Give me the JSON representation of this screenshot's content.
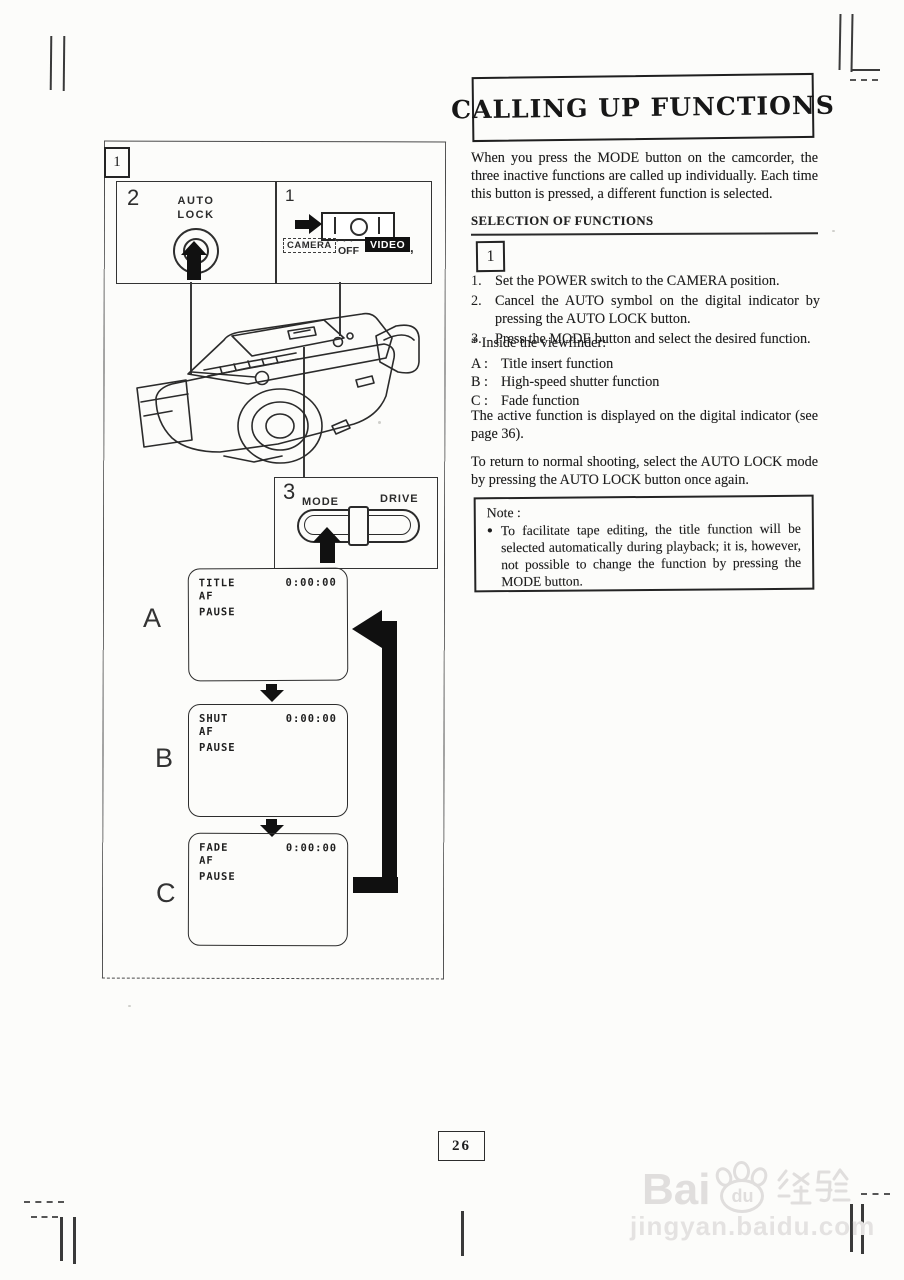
{
  "page": {
    "number": "26"
  },
  "colors": {
    "ink": "#222222",
    "paper": "#fcfcfa",
    "badge_bg": "#111111",
    "badge_fg": "#ffffff",
    "watermark": "#e0dedd"
  },
  "article": {
    "title": "CALLING UP FUNCTIONS",
    "intro": "When you press the MODE button on the camcorder, the three inactive functions are called up individually. Each time this button is pressed, a different function is selected.",
    "section_heading": "SELECTION OF FUNCTIONS",
    "section_box_label": "1",
    "steps": [
      {
        "num": "1.",
        "text": "Set the POWER switch to the CAMERA position."
      },
      {
        "num": "2.",
        "text": "Cancel the AUTO symbol on the digital indicator by pressing the AUTO LOCK button."
      },
      {
        "num": "3.",
        "text": "Press the MODE button and select the desired function."
      }
    ],
    "viewfinder": {
      "intro": "* Inside the viewfinder:",
      "items": [
        {
          "key": "A :",
          "text": "Title insert function"
        },
        {
          "key": "B :",
          "text": "High-speed shutter function"
        },
        {
          "key": "C :",
          "text": "Fade function"
        }
      ]
    },
    "para_active": "The active function is displayed on the digital indicator (see page 36).",
    "para_return": "To return to normal shooting, select the AUTO LOCK mode by pressing the AUTO LOCK button once again.",
    "note": {
      "label": "Note :",
      "bullet": "●",
      "text": "To facilitate tape editing, the title function will be selected automatically during playback; it is, however, not possible to change the function by pressing the MODE button."
    }
  },
  "figure": {
    "label": "1",
    "auto_lock_panel": {
      "num": "2",
      "line1": "AUTO",
      "line2": "LOCK"
    },
    "power_panel": {
      "num": "1",
      "camera": "CAMERA",
      "dots": "• • •",
      "off": "OFF",
      "video": "VIDEO",
      "comma": ","
    },
    "mode_panel": {
      "num": "3",
      "mode": "MODE",
      "drive": "DRIVE"
    },
    "screens": [
      {
        "label": "A",
        "name": "TITLE",
        "line2": "AF",
        "line3": "PAUSE",
        "counter": "0:00:00"
      },
      {
        "label": "B",
        "name": "SHUT",
        "line2": "AF",
        "line3": "PAUSE",
        "counter": "0:00:00"
      },
      {
        "label": "C",
        "name": "FADE",
        "line2": "AF",
        "line3": "PAUSE",
        "counter": "0:00:00"
      }
    ]
  },
  "watermark": {
    "bai": "Bai",
    "du": "du",
    "cn": "经验",
    "url": "jingyan.baidu.com"
  }
}
